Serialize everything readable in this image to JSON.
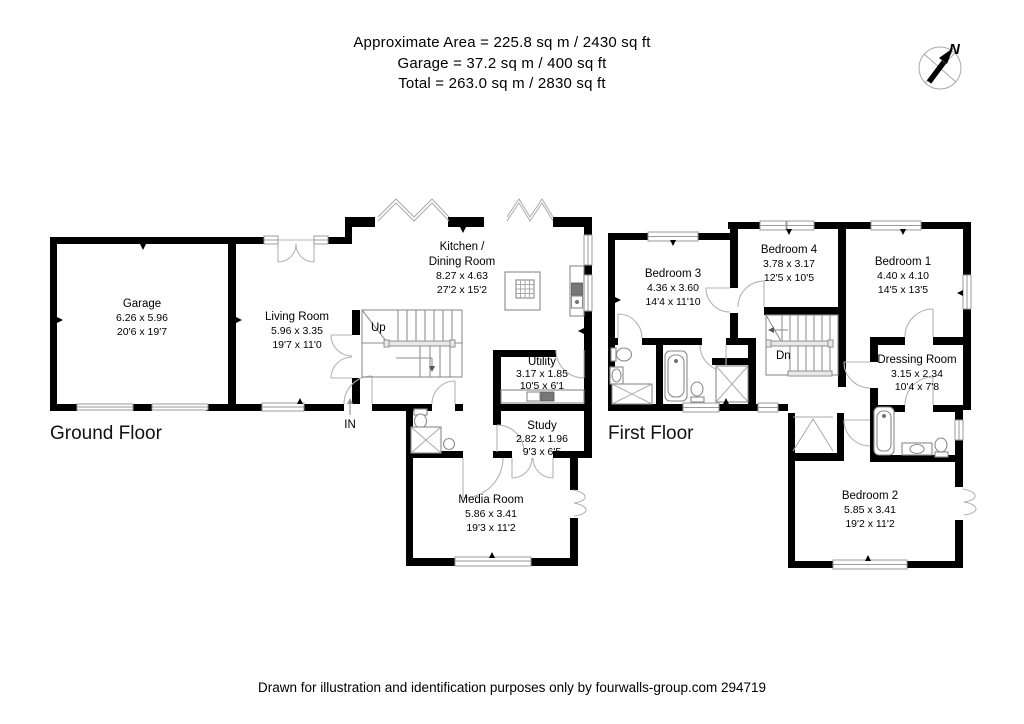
{
  "header": {
    "line1": "Approximate  Area = 225.8 sq m / 2430 sq ft",
    "line2": "Garage = 37.2 sq m / 400 sq ft",
    "line3": "Total = 263.0 sq m / 2830 sq ft"
  },
  "compass": {
    "north_label": "N"
  },
  "ground_floor": {
    "label": "Ground Floor",
    "stairs_label": "Up",
    "entrance_label": "IN",
    "rooms": {
      "garage": {
        "name": "Garage",
        "metric": "6.26 x 5.96",
        "imperial": "20'6 x 19'7"
      },
      "living_room": {
        "name": "Living Room",
        "metric": "5.96 x 3.35",
        "imperial": "19'7 x 11'0"
      },
      "kitchen": {
        "name_line1": "Kitchen /",
        "name_line2": "Dining Room",
        "metric": "8.27 x 4.63",
        "imperial": "27'2 x 15'2"
      },
      "utility": {
        "name": "Utility",
        "metric": "3.17 x 1.85",
        "imperial": "10'5 x 6'1"
      },
      "study": {
        "name": "Study",
        "metric": "2.82 x 1.96",
        "imperial": "9'3 x 6'5"
      },
      "media_room": {
        "name": "Media Room",
        "metric": "5.86 x 3.41",
        "imperial": "19'3 x 11'2"
      }
    }
  },
  "first_floor": {
    "label": "First Floor",
    "stairs_label": "Dn",
    "rooms": {
      "bedroom1": {
        "name": "Bedroom 1",
        "metric": "4.40 x 4.10",
        "imperial": "14'5 x 13'5"
      },
      "bedroom2": {
        "name": "Bedroom 2",
        "metric": "5.85 x 3.41",
        "imperial": "19'2 x 11'2"
      },
      "bedroom3": {
        "name": "Bedroom 3",
        "metric": "4.36 x 3.60",
        "imperial": "14'4 x 11'10"
      },
      "bedroom4": {
        "name": "Bedroom 4",
        "metric": "3.78 x 3.17",
        "imperial": "12'5 x 10'5"
      },
      "dressing_room": {
        "name": "Dressing Room",
        "metric": "3.15 x 2.34",
        "imperial": "10'4 x 7'8"
      }
    }
  },
  "footer": {
    "text": "Drawn for illustration and identification purposes only by fourwalls-group.com  294719"
  }
}
